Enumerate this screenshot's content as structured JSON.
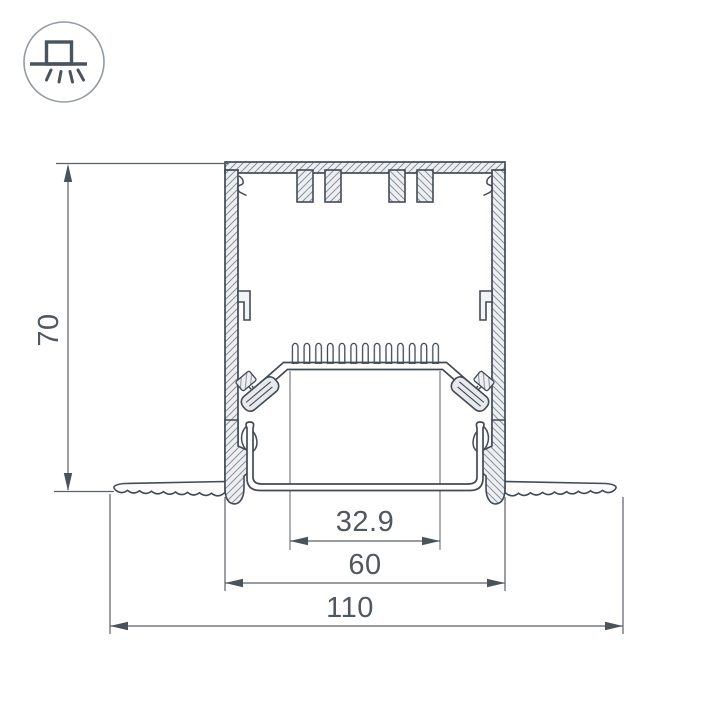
{
  "icon": {
    "name": "recessed-mounted-luminaire-icon"
  },
  "dimensions": {
    "height": "70",
    "window_width": "32.9",
    "body_width": "60",
    "overall_width": "110"
  },
  "colors": {
    "outline": "#414b55",
    "dimension_line": "#5a626a",
    "label_text": "#4f575f",
    "hatch": "#8a939c",
    "metal_fill": "#edeff2",
    "background": "#ffffff"
  }
}
